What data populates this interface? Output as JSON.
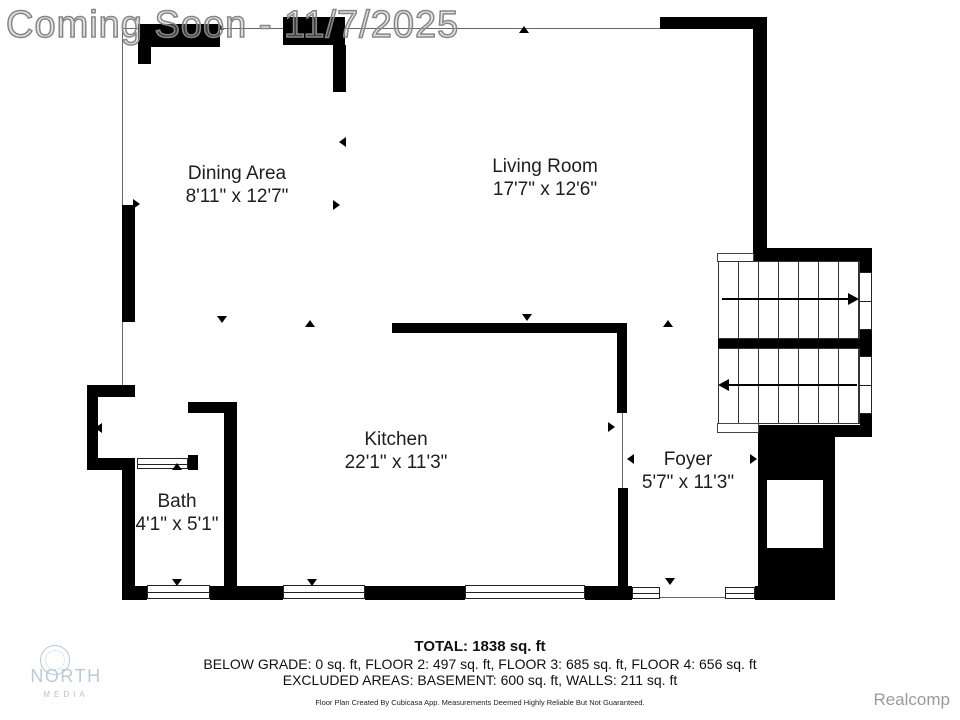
{
  "watermark": "Coming Soon - 11/7/2025",
  "rooms": [
    {
      "name": "Dining Area",
      "dims": "8'11\" x 12'7\""
    },
    {
      "name": "Living Room",
      "dims": "17'7\" x 12'6\""
    },
    {
      "name": "Kitchen",
      "dims": "22'1\" x 11'3\""
    },
    {
      "name": "Foyer",
      "dims": "5'7\" x 11'3\""
    },
    {
      "name": "Bath",
      "dims": "4'1\" x 5'1\""
    }
  ],
  "summary": {
    "total": "TOTAL: 1838 sq. ft",
    "floors": "BELOW GRADE: 0 sq. ft, FLOOR 2: 497 sq. ft, FLOOR 3: 685 sq. ft, FLOOR 4: 656 sq. ft",
    "excluded": "EXCLUDED AREAS: BASEMENT: 600 sq. ft, WALLS: 211 sq. ft",
    "disclaimer": "Floor Plan Created By Cubicasa App. Measurements Deemed Highly Reliable But Not Guaranteed."
  },
  "branding": {
    "logo_line1": "NORTH",
    "logo_line2": "MEDIA",
    "mls": "Realcomp"
  },
  "colors": {
    "wall": "#000000",
    "watermark_gray": "#878787",
    "logo_blue": "#b7ccd8",
    "mls_gray": "#9a9a9a"
  }
}
